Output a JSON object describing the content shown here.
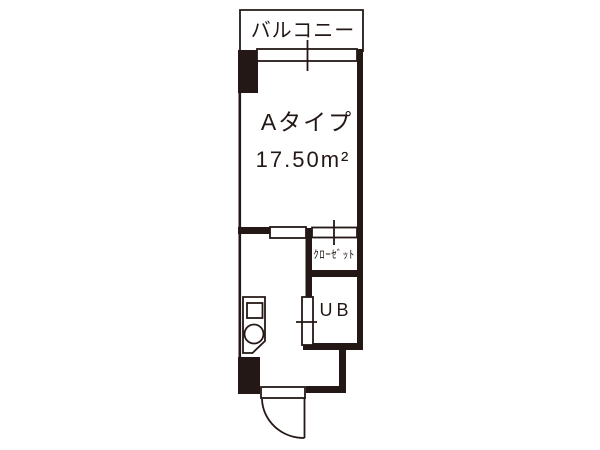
{
  "floorplan": {
    "labels": {
      "balcony": "バルコニー",
      "unit_type": "Aタイプ",
      "area": "17.50m²",
      "closet": "ｸﾛｰｾﾞｯﾄ",
      "unit_bath": "UB"
    },
    "colors": {
      "ink": "#231815",
      "background": "#ffffff"
    }
  }
}
